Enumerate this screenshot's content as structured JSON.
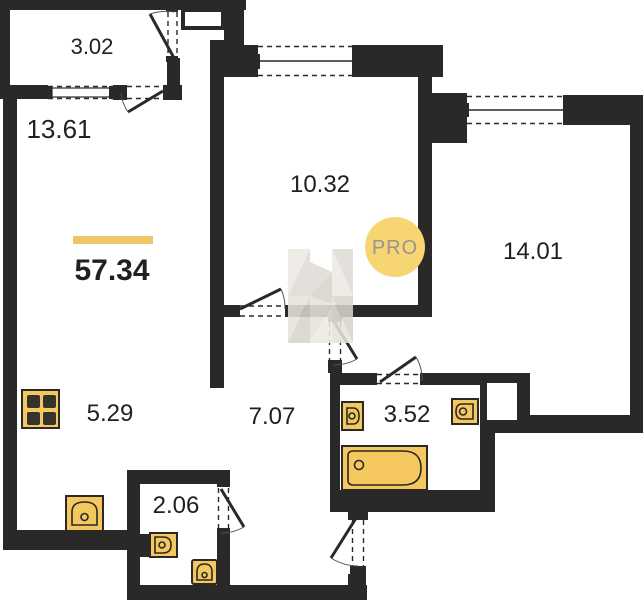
{
  "plan": {
    "title": "apartment-floor-plan",
    "total_area": "57.34",
    "badge": "PRO",
    "rooms": [
      {
        "name": "balcony",
        "area": "3.02"
      },
      {
        "name": "living-room",
        "area": "13.61"
      },
      {
        "name": "bedroom",
        "area": "10.32"
      },
      {
        "name": "bedroom-2",
        "area": "14.01"
      },
      {
        "name": "kitchen",
        "area": "5.29"
      },
      {
        "name": "hallway",
        "area": "7.07"
      },
      {
        "name": "bathroom",
        "area": "3.52"
      },
      {
        "name": "wc",
        "area": "2.06"
      }
    ],
    "colors": {
      "wall": "#2a2927",
      "fixture": "#f5c75f",
      "accent": "#f0c469",
      "badge_bg": "#f8d573",
      "badge_text": "#97948f",
      "watermark": "#e4e1db"
    }
  }
}
